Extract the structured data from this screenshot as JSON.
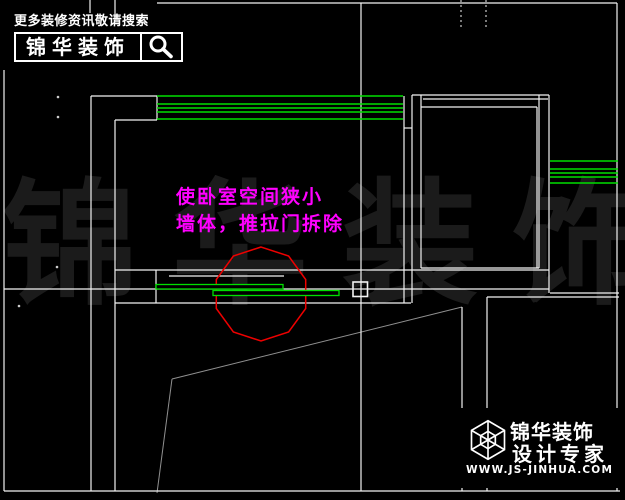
{
  "promo": {
    "tagline": "更多装修资讯敬请搜索",
    "brand": "锦华装饰"
  },
  "annotation": {
    "lines": [
      "使卧室空间狭小",
      "墙体，推拉门拆除"
    ],
    "color": "#ff00ff"
  },
  "watermark": {
    "text": "锦华装饰"
  },
  "footer": {
    "brand": "锦华装饰",
    "subtitle": "设计专家",
    "url": "WWW.JS-JINHUA.COM"
  },
  "colors": {
    "background": "#000000",
    "wall": "#f2f2f2",
    "window_green": "#00e000",
    "dim_gray": "#909090",
    "highlight_red": "#ee0000",
    "watermark": "#1b1b1b",
    "dot": "#cccccc"
  },
  "drawing": {
    "wall_lines": [
      [
        4,
        70,
        4,
        491
      ],
      [
        4,
        491,
        620,
        491
      ],
      [
        617,
        3,
        617,
        491
      ],
      [
        157,
        3,
        617,
        3
      ],
      [
        91,
        96,
        91,
        491
      ],
      [
        115,
        120,
        115,
        491
      ],
      [
        91,
        96,
        157,
        96
      ],
      [
        115,
        120,
        157,
        120
      ],
      [
        157,
        96,
        157,
        120
      ],
      [
        404,
        96,
        404,
        303
      ],
      [
        412,
        95,
        412,
        303
      ],
      [
        404,
        128,
        412,
        128
      ],
      [
        412,
        95,
        549,
        95
      ],
      [
        423,
        99,
        548,
        99
      ],
      [
        421,
        95,
        421,
        268
      ],
      [
        421,
        107,
        537,
        107
      ],
      [
        537,
        107,
        537,
        268
      ],
      [
        421,
        268,
        539,
        268
      ],
      [
        539,
        95,
        539,
        268
      ],
      [
        549,
        95,
        549,
        293
      ],
      [
        115,
        270,
        549,
        270
      ],
      [
        4,
        289,
        549,
        289
      ],
      [
        115,
        303,
        411,
        303
      ],
      [
        156,
        270,
        156,
        303
      ],
      [
        169,
        276,
        284,
        276
      ],
      [
        361,
        3,
        361,
        491
      ],
      [
        550,
        293,
        619,
        293
      ],
      [
        487,
        297,
        619,
        297
      ],
      [
        462,
        307,
        462,
        491
      ],
      [
        487,
        297,
        487,
        491
      ]
    ],
    "tick_lines": [
      [
        90,
        0,
        90,
        13
      ],
      [
        115,
        0,
        115,
        18
      ]
    ],
    "dashed_lines": [
      [
        461,
        0,
        461,
        30
      ],
      [
        486,
        0,
        486,
        30
      ]
    ],
    "gray_lines": [
      [
        462,
        307,
        172,
        379
      ],
      [
        172,
        379,
        157,
        493
      ]
    ],
    "green_lines": [
      [
        157,
        96,
        403,
        96
      ],
      [
        157,
        104,
        403,
        104
      ],
      [
        157,
        108,
        403,
        108
      ],
      [
        157,
        112,
        403,
        112
      ],
      [
        157,
        119,
        403,
        119
      ],
      [
        550,
        161,
        618,
        161
      ],
      [
        550,
        169,
        618,
        169
      ],
      [
        550,
        173,
        618,
        173
      ],
      [
        550,
        177,
        618,
        177
      ],
      [
        550,
        183,
        618,
        183
      ]
    ],
    "door_panels": [
      {
        "x": 156,
        "y": 284.5,
        "w": 127,
        "h": 4.5
      },
      {
        "x": 213,
        "y": 290.5,
        "w": 126,
        "h": 5
      }
    ],
    "grip_square": {
      "x": 353,
      "y": 282,
      "w": 14.5,
      "h": 14.5
    },
    "node_dots": [
      [
        58,
        97
      ],
      [
        58,
        117
      ],
      [
        57,
        267
      ],
      [
        19,
        306
      ]
    ],
    "highlight_circle": {
      "cx": 261,
      "cy": 294,
      "r": 47,
      "sides": 10
    }
  }
}
